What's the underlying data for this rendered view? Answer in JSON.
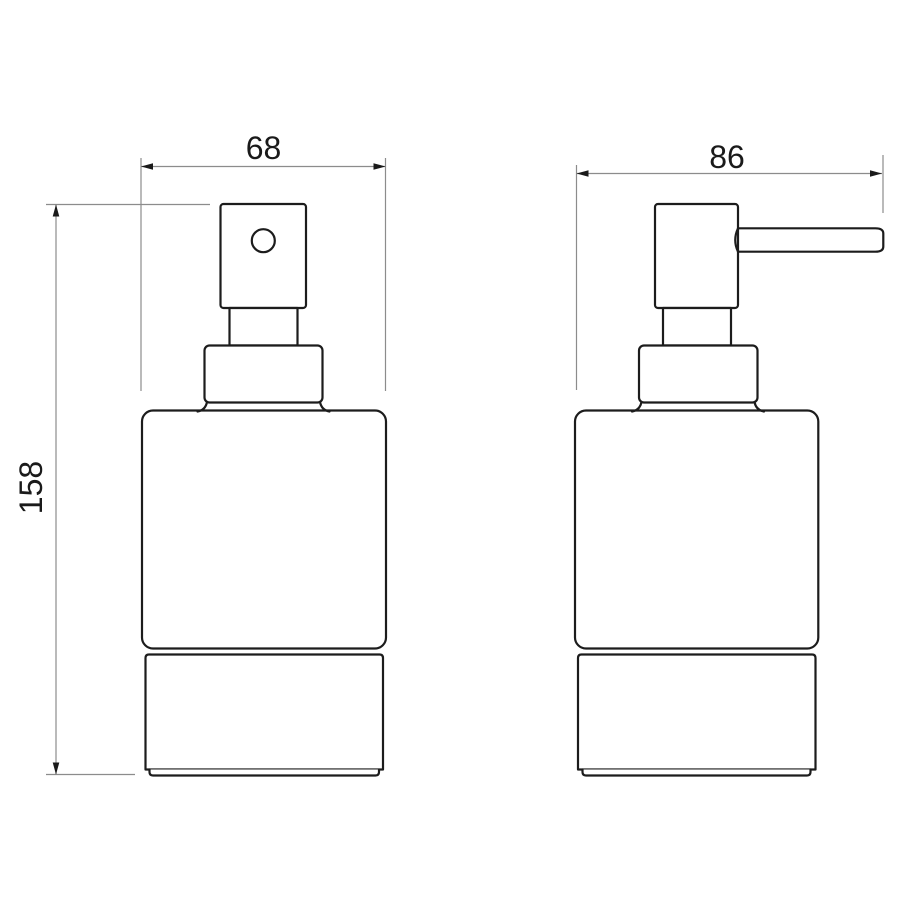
{
  "drawing": {
    "dimensions": {
      "front_width": "68",
      "side_depth": "86",
      "height": "158"
    },
    "colors": {
      "background": "#ffffff",
      "object_line": "#1c1c1c",
      "dimension_line": "#8c8c8c",
      "text": "#1a1a1a"
    }
  }
}
